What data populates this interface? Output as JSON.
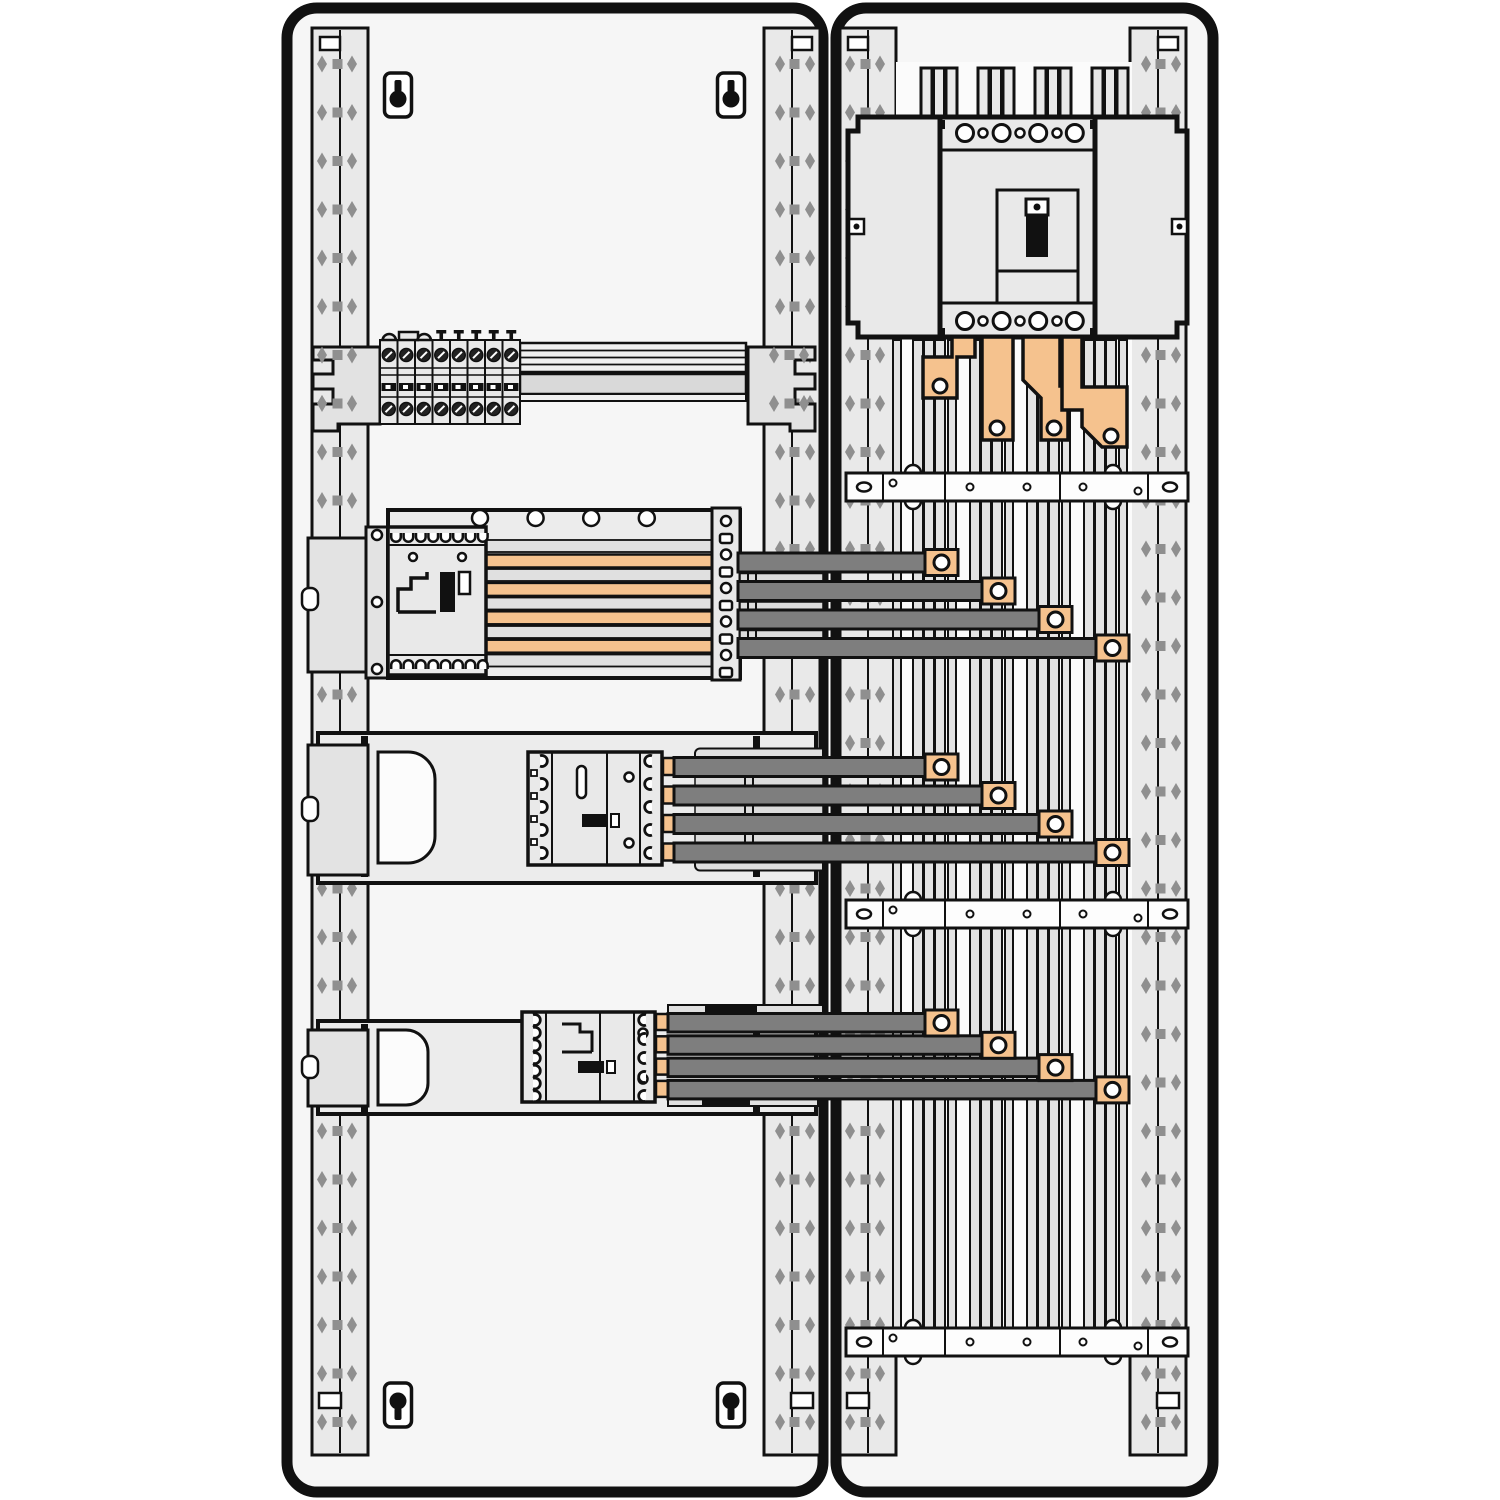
{
  "palette": {
    "background": "#ffffff",
    "outline": "#111111",
    "panel_fill": "#f6f6f6",
    "rail_fill": "#e9e9e9",
    "rail_hole": "#8f8f8f",
    "plate_fill": "#ececec",
    "device_fill": "#e9e9e9",
    "band_fill": "#e0e0e0",
    "din_band": "#d9d9d9",
    "white_part": "#fdfdfd",
    "copper": "#f5c28e",
    "bar_dark": "#7e7e7e",
    "busbar": "#e3e3e3",
    "spacer": "#dcdcdc"
  },
  "enclosures": {
    "left": {
      "mounting_rails": 2,
      "keyholes": 4,
      "terminal_row": {
        "modules": 8,
        "screws_per_module": 2
      },
      "breaker_row_mid": {
        "phase_bars_orange": 4,
        "feeder_bars": 4,
        "clamps": 4,
        "backplate_circles": 4
      },
      "breaker_row_lower": {
        "feeder_bars": 4,
        "clamps": 4
      },
      "breaker_row_bottom": {
        "feeder_bars": 4,
        "clamps": 4
      }
    },
    "right": {
      "mounting_rails": 2,
      "main_breaker": {
        "terminals_large": 4,
        "terminals_small": 3,
        "toggle": 1
      },
      "copper_links": 4,
      "vertical_busbar_clusters": 4,
      "bars_per_cluster": 3,
      "support_brackets": 3
    }
  }
}
